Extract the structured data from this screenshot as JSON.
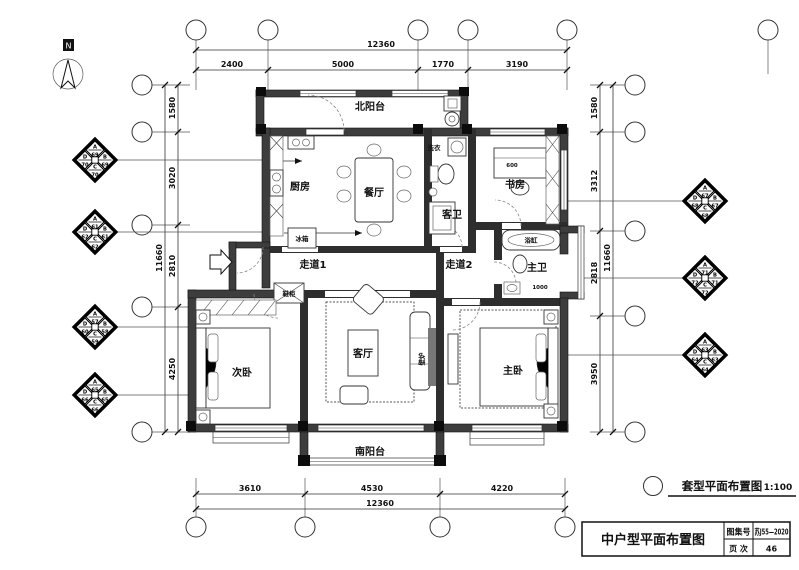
{
  "north": {
    "label": "N"
  },
  "rooms": {
    "north_balcony": "北阳台",
    "kitchen": "厨房",
    "dining": "餐厅",
    "guest_bath": "客卫",
    "study": "书房",
    "corridor1": "走道1",
    "corridor2": "走道2",
    "master_bath": "主卫",
    "second_bedroom": "次卧",
    "living": "客厅",
    "master_bedroom": "主卧",
    "south_balcony": "南阳台"
  },
  "fixtures": {
    "fridge": "冰箱",
    "laundry": "洗衣",
    "shoe_cabinet": "鞋柜",
    "fireplace": "壁炉",
    "bathtub": "浴缸"
  },
  "small_dims": {
    "desk": "600",
    "bath": "1000"
  },
  "dims": {
    "top": {
      "overall": "12360",
      "segments": [
        "2400",
        "5000",
        "1770",
        "3190"
      ]
    },
    "bottom": {
      "overall": "12360",
      "segments": [
        "3610",
        "4530",
        "4220"
      ]
    },
    "left": {
      "overall": "11660",
      "segments": [
        "1580",
        "3020",
        "2810",
        "4250"
      ]
    },
    "right": {
      "overall": "11660",
      "segments": [
        "1580",
        "3312",
        "2818",
        "3950"
      ]
    }
  },
  "markers": {
    "left": [
      {
        "a": "A",
        "an": "69",
        "b": "B",
        "bn": "69",
        "c": "C",
        "cn": "70",
        "d": "D",
        "dn": "70"
      },
      {
        "a": "A",
        "an": "61",
        "b": "B",
        "bn": "61",
        "c": "C",
        "cn": "62",
        "d": "D",
        "dn": "62"
      },
      {
        "a": "A",
        "an": "57",
        "b": "B",
        "bn": "58",
        "c": "C",
        "cn": "59",
        "d": "D",
        "dn": "60"
      },
      {
        "a": "A",
        "an": "65",
        "b": "B",
        "bn": "65",
        "c": "C",
        "cn": "66",
        "d": "D",
        "dn": "66"
      }
    ],
    "right": [
      {
        "a": "A",
        "an": "67",
        "b": "B",
        "bn": "67",
        "c": "C",
        "cn": "68",
        "d": "D",
        "dn": "68"
      },
      {
        "a": "A",
        "an": "71",
        "b": "B",
        "bn": "71",
        "c": "C",
        "cn": "72",
        "d": "D",
        "dn": "72"
      },
      {
        "a": "A",
        "an": "63",
        "b": "B",
        "bn": "63",
        "c": "C",
        "cn": "64",
        "d": "D",
        "dn": "64"
      }
    ]
  },
  "scale_note": {
    "title": "套型平面布置图",
    "scale": "1:100"
  },
  "title_block": {
    "title": "中户型平面布置图",
    "atlas_label": "图集号",
    "atlas_value": "苏J55—2020",
    "page_label": "页 次",
    "page_value": "46"
  }
}
